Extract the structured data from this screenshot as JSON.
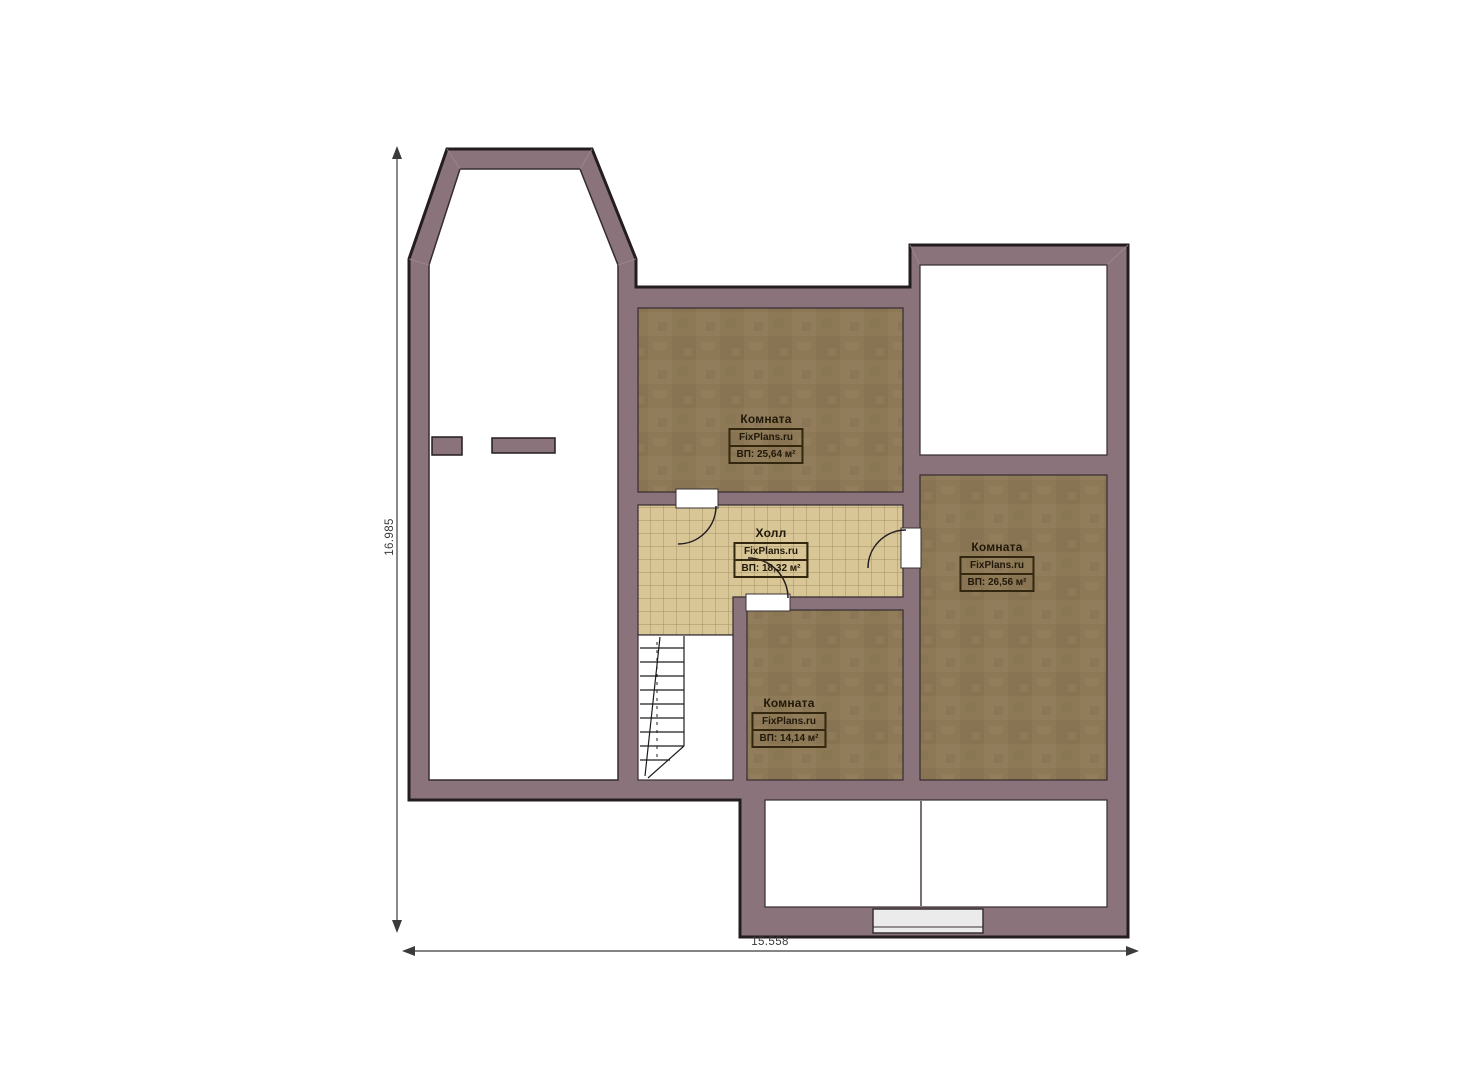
{
  "plan": {
    "labels": {
      "room_top": {
        "name": "Комната",
        "brand": "FixPlans.ru",
        "area": "ВП: 25,64 м²"
      },
      "hall": {
        "name": "Холл",
        "brand": "FixPlans.ru",
        "area": "ВП: 18,32 м²"
      },
      "room_right": {
        "name": "Комната",
        "brand": "FixPlans.ru",
        "area": "ВП: 26,56 м²"
      },
      "room_bottom": {
        "name": "Комната",
        "brand": "FixPlans.ru",
        "area": "ВП: 14,14 м²"
      }
    },
    "dimensions": {
      "vertical": "16.985",
      "horizontal": "15.558"
    },
    "colors": {
      "wall": "#8b737b",
      "outline": "#231d20",
      "floor_wood": "#8d7956",
      "floor_tile": "#d8c697",
      "tile_line": "#a59065",
      "window": "#ebebeb",
      "white_room": "#ffffff"
    }
  }
}
